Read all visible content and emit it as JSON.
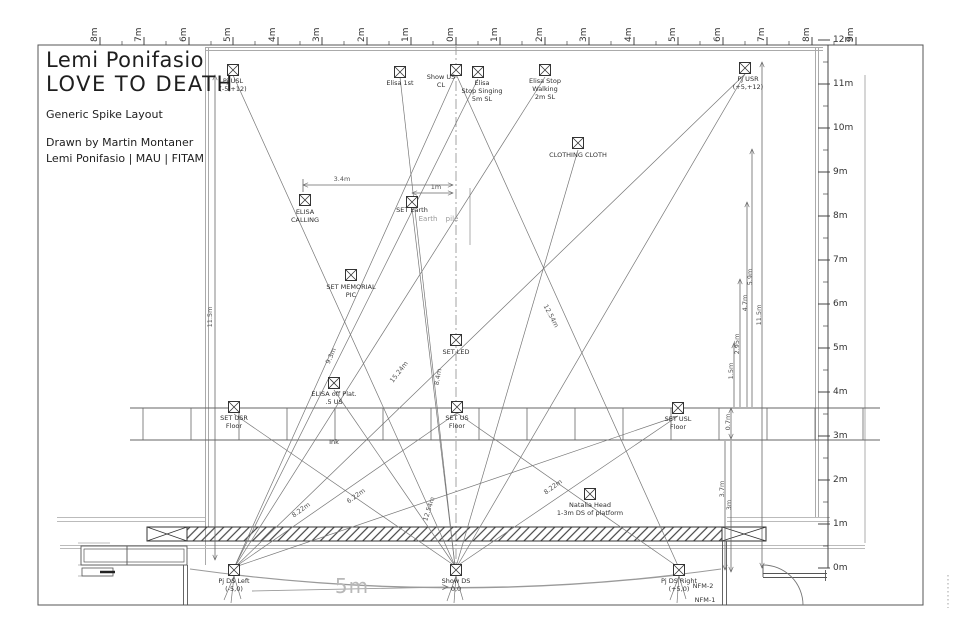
{
  "title_block": {
    "line1": "Lemi Ponifasio",
    "line2": "LOVE TO DEATH",
    "subtitle": "Generic Spike  Layout",
    "credit1": "Drawn by Martin Montaner",
    "credit2": "Lemi Ponifasio | MAU | FITAM"
  },
  "rulers": {
    "top": [
      {
        "t": "8m",
        "x": 100
      },
      {
        "t": "7m",
        "x": 144
      },
      {
        "t": "6m",
        "x": 189
      },
      {
        "t": "5m",
        "x": 233
      },
      {
        "t": "4m",
        "x": 278
      },
      {
        "t": "3m",
        "x": 322
      },
      {
        "t": "2m",
        "x": 367
      },
      {
        "t": "1m",
        "x": 411
      },
      {
        "t": "0m",
        "x": 456
      },
      {
        "t": "1m",
        "x": 500
      },
      {
        "t": "2m",
        "x": 545
      },
      {
        "t": "3m",
        "x": 589
      },
      {
        "t": "4m",
        "x": 634
      },
      {
        "t": "5m",
        "x": 678
      },
      {
        "t": "6m",
        "x": 723
      },
      {
        "t": "7m",
        "x": 767
      },
      {
        "t": "8m",
        "x": 812
      },
      {
        "t": "9m",
        "x": 856
      }
    ],
    "right": [
      {
        "t": "12m",
        "y": 40
      },
      {
        "t": "11m",
        "y": 84
      },
      {
        "t": "10m",
        "y": 128
      },
      {
        "t": "9m",
        "y": 172
      },
      {
        "t": "8m",
        "y": 216
      },
      {
        "t": "7m",
        "y": 260
      },
      {
        "t": "6m",
        "y": 304
      },
      {
        "t": "5m",
        "y": 348
      },
      {
        "t": "4m",
        "y": 392
      },
      {
        "t": "3m",
        "y": 436
      },
      {
        "t": "2m",
        "y": 480
      },
      {
        "t": "1m",
        "y": 524
      },
      {
        "t": "0m",
        "y": 568
      }
    ]
  },
  "markers": [
    {
      "id": "pj-usl",
      "label": "Pj USL\n(-5,+12)",
      "x": 233,
      "y": 70,
      "lx": 233,
      "ly": 78
    },
    {
      "id": "elisa-1st",
      "label": "Elisa 1st",
      "x": 400,
      "y": 72,
      "lx": 400,
      "ly": 80
    },
    {
      "id": "show-us",
      "label": "Show US\nCL",
      "x": 456,
      "y": 70,
      "lx": 441,
      "ly": 74
    },
    {
      "id": "elisa-stop-singing",
      "label": "Elisa\nStop Singing\n5m SL",
      "x": 478,
      "y": 72,
      "lx": 482,
      "ly": 80
    },
    {
      "id": "elisa-stop-walking",
      "label": "Elisa Stop\nWalking\n2m SL",
      "x": 545,
      "y": 70,
      "lx": 545,
      "ly": 78
    },
    {
      "id": "pj-usr",
      "label": "Pj USR\n(+5,+12)",
      "x": 745,
      "y": 68,
      "lx": 748,
      "ly": 76
    },
    {
      "id": "clothing-cloth",
      "label": "CLOTHING CLOTH",
      "x": 578,
      "y": 143,
      "lx": 578,
      "ly": 152
    },
    {
      "id": "elisa-calling",
      "label": "ELISA\nCALLING",
      "x": 305,
      "y": 200,
      "lx": 305,
      "ly": 209
    },
    {
      "id": "set-earth",
      "label": "SET Earth",
      "x": 412,
      "y": 202,
      "lx": 412,
      "ly": 207
    },
    {
      "id": "set-memorial-pic",
      "label": "SET MEMORIAL\nPIC",
      "x": 351,
      "y": 275,
      "lx": 351,
      "ly": 284
    },
    {
      "id": "set-led",
      "label": "SET LED",
      "x": 456,
      "y": 340,
      "lx": 456,
      "ly": 349
    },
    {
      "id": "elisa-off-plat",
      "label": "ELISA off Plat.\n.5 US",
      "x": 334,
      "y": 383,
      "lx": 334,
      "ly": 391
    },
    {
      "id": "set-usr",
      "label": "SET USR\nFloor",
      "x": 234,
      "y": 407,
      "lx": 234,
      "ly": 415
    },
    {
      "id": "set-us",
      "label": "SET US\nFloor",
      "x": 457,
      "y": 407,
      "lx": 457,
      "ly": 415
    },
    {
      "id": "set-usl",
      "label": "SET USL\nFloor",
      "x": 678,
      "y": 408,
      "lx": 678,
      "ly": 416
    },
    {
      "id": "natalia-head",
      "label": "Natalia Head\n1-3m DS of platform",
      "x": 590,
      "y": 494,
      "lx": 590,
      "ly": 502
    },
    {
      "id": "pj-ds-left",
      "label": "Pj DS Left\n(-5,0)",
      "x": 234,
      "y": 570,
      "lx": 234,
      "ly": 578
    },
    {
      "id": "show-ds",
      "label": "Show DS\n0,0",
      "x": 456,
      "y": 570,
      "lx": 456,
      "ly": 578
    },
    {
      "id": "pj-ds-right",
      "label": "Pj DS Right\n(+5,0)",
      "x": 679,
      "y": 570,
      "lx": 679,
      "ly": 578
    }
  ],
  "dim_labels": [
    {
      "t": "3.4m",
      "x": 342,
      "y": 179,
      "r": 0
    },
    {
      "t": "1m",
      "x": 436,
      "y": 187,
      "r": 0
    },
    {
      "t": "11.5m",
      "x": 210,
      "y": 317,
      "r": -90
    },
    {
      "t": "11.5m",
      "x": 759,
      "y": 315,
      "r": -90
    },
    {
      "t": "5.9m",
      "x": 750,
      "y": 277,
      "r": -90
    },
    {
      "t": "4.7m",
      "x": 745,
      "y": 303,
      "r": -90
    },
    {
      "t": "2.95m",
      "x": 737,
      "y": 344,
      "r": -90
    },
    {
      "t": "1.5m",
      "x": 731,
      "y": 371,
      "r": -90
    },
    {
      "t": "0.7m",
      "x": 728,
      "y": 422,
      "r": -90
    },
    {
      "t": "3.7m",
      "x": 722,
      "y": 489,
      "r": -90
    },
    {
      "t": "3m",
      "x": 729,
      "y": 505,
      "r": -90
    },
    {
      "t": "9.3m",
      "x": 331,
      "y": 356,
      "r": -66
    },
    {
      "t": "15.24m",
      "x": 399,
      "y": 372,
      "r": -52
    },
    {
      "t": "8.4m",
      "x": 438,
      "y": 377,
      "r": -80
    },
    {
      "t": "12.54m",
      "x": 551,
      "y": 316,
      "r": 62
    },
    {
      "t": "12.54m",
      "x": 429,
      "y": 509,
      "r": -72
    },
    {
      "t": "6.22m",
      "x": 356,
      "y": 496,
      "r": -35
    },
    {
      "t": "8.22m",
      "x": 301,
      "y": 510,
      "r": -36
    },
    {
      "t": "8.22m",
      "x": 553,
      "y": 487,
      "r": -36
    }
  ],
  "annotations": [
    {
      "t": "Earth",
      "x": 428,
      "y": 215,
      "cls": "ann-gray"
    },
    {
      "t": "pile",
      "x": 452,
      "y": 215,
      "cls": "ann-gray"
    },
    {
      "t": "Ink",
      "x": 334,
      "y": 438,
      "cls": "ann-small"
    },
    {
      "t": "NFM-2",
      "x": 703,
      "y": 582,
      "cls": "ann-small"
    },
    {
      "t": "NFM-1",
      "x": 705,
      "y": 596,
      "cls": "ann-small"
    },
    {
      "t": "5m",
      "x": 352,
      "y": 574,
      "cls": "ann-big"
    }
  ],
  "colors": {
    "line": "#4a4a4a",
    "mid": "#666666",
    "gray": "#9a9a9a",
    "light": "#bbbbbb"
  }
}
